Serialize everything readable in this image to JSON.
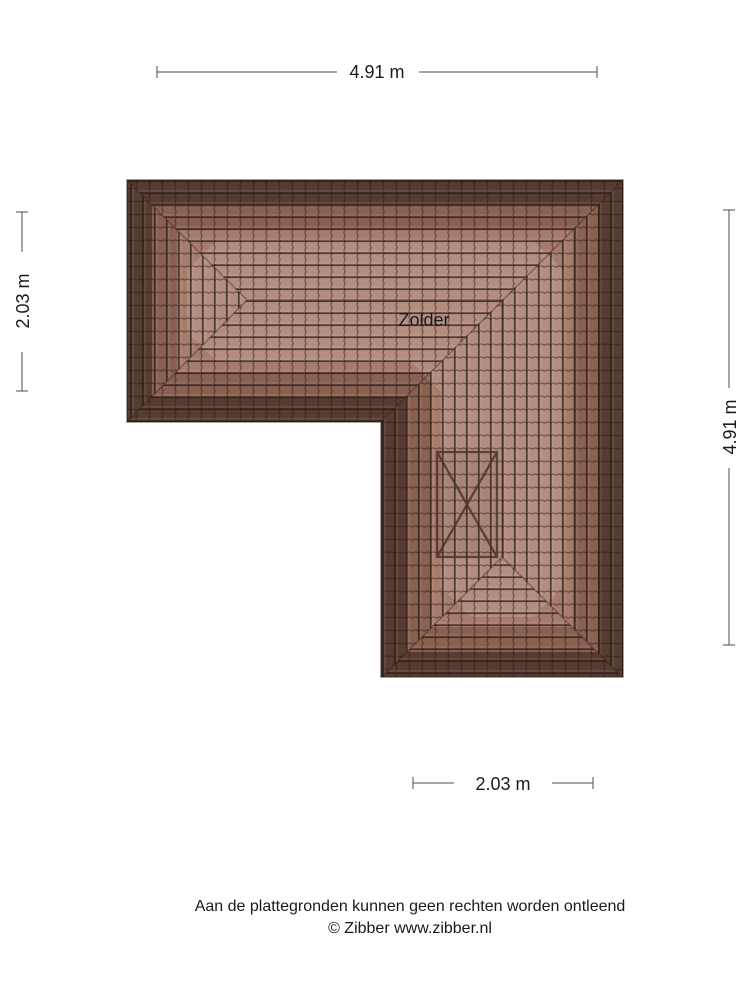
{
  "plan": {
    "room_label": "Zolder",
    "type": "roof-plan-attic",
    "colors": {
      "roof_light": "#a87c6c",
      "roof_mid": "#8a6151",
      "roof_dark": "#573c30",
      "tile_line": "#241a14",
      "hip_line": "#2d2018",
      "marker_line": "#4b3429",
      "dimension_line": "#4d4d4d",
      "text": "#1a1a1a"
    }
  },
  "dimensions": {
    "top": "4.91 m",
    "left": "2.03 m",
    "right": "4.91 m",
    "bottom": "2.03 m"
  },
  "footer": {
    "disclaimer": "Aan de plattegronden kunnen geen rechten worden ontleend",
    "copyright": "© Zibber www.zibber.nl"
  }
}
